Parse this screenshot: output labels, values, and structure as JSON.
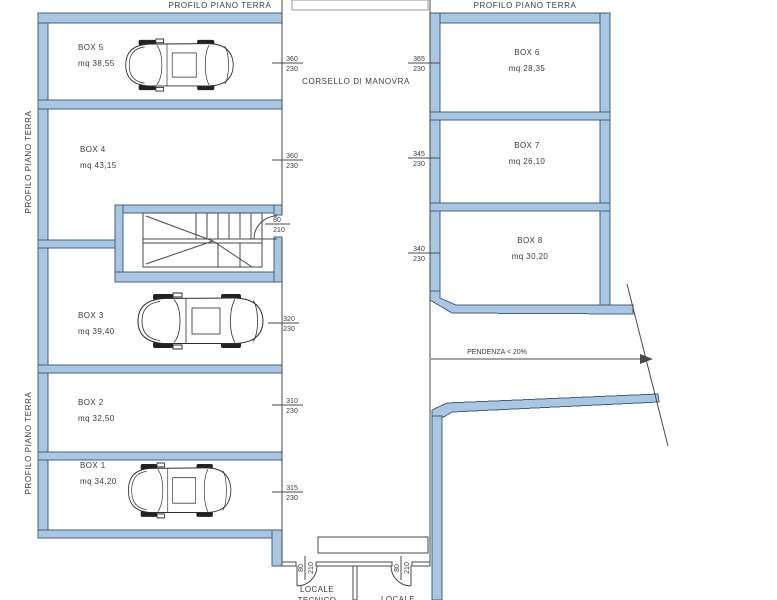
{
  "plan": {
    "profile_label": "PROFILO PIANO TERRA",
    "corridor_label": "CORSELLO DI MANOVRA",
    "ramp_label": "PENDENZA < 20%",
    "rooms": {
      "tecnico_line1": "LOCALE",
      "tecnico_line2": "TECNICO",
      "locale_line1": "LOCALE"
    },
    "boxes": [
      {
        "name": "BOX 5",
        "area": "mq 38,55",
        "door_w": "360",
        "door_h": "230"
      },
      {
        "name": "BOX 4",
        "area": "mq 43,15",
        "door_w": "360",
        "door_h": "230"
      },
      {
        "name": "BOX 3",
        "area": "mq 39,40",
        "door_w": "320",
        "door_h": "230"
      },
      {
        "name": "BOX  2",
        "area": "mq 32,50",
        "door_w": "310",
        "door_h": "230"
      },
      {
        "name": "BOX  1",
        "area": "mq 34,20",
        "door_w": "315",
        "door_h": "230"
      },
      {
        "name": "BOX 6",
        "area": "mq 28,35",
        "door_w": "365",
        "door_h": "230"
      },
      {
        "name": "BOX 7",
        "area": "mq 26,10",
        "door_w": "345",
        "door_h": "230"
      },
      {
        "name": "BOX 8",
        "area": "mq 30,20",
        "door_w": "340",
        "door_h": "230"
      }
    ],
    "stair_door": {
      "w": "80",
      "h": "210"
    },
    "service_door_1": {
      "w": "80",
      "h": "210"
    },
    "service_door_2": {
      "w": "80",
      "h": "210"
    },
    "colors": {
      "wall_fill": "#a9c6e3",
      "wall_stroke": "#46607e",
      "line": "#4a4a4a"
    }
  }
}
